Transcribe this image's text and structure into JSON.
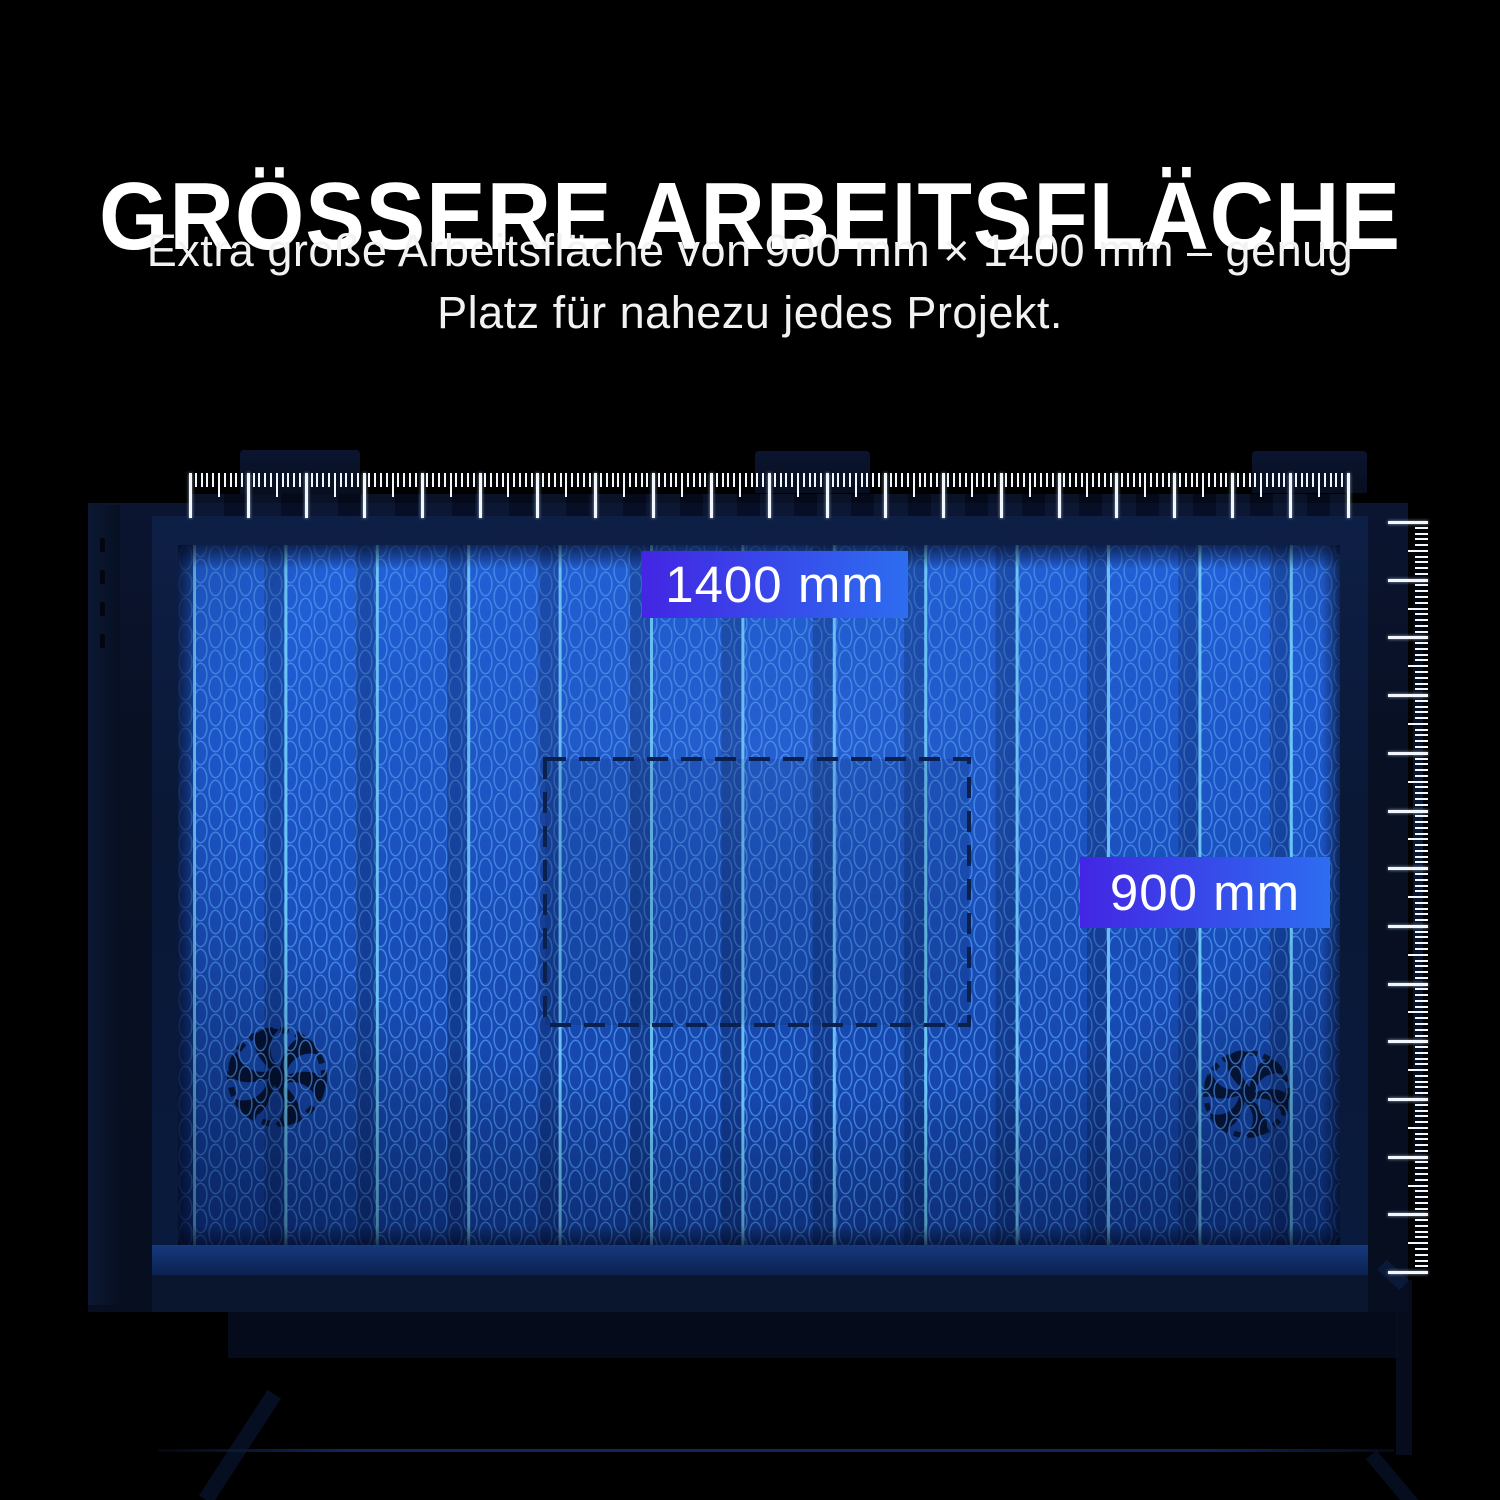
{
  "header": {
    "title": "GRÖSSERE ARBEITSFLÄCHE",
    "subtitle": [
      "Extra große Arbeitsfläche von 900 mm × 1400 mm – genug",
      "Platz für nahezu jedes Projekt."
    ]
  },
  "dimension_labels": {
    "width": "1400 mm",
    "height": "900 mm"
  },
  "work_area": {
    "width_mm": 1400,
    "height_mm": 900
  },
  "colors": {
    "background": "#000000",
    "label_gradient_from": "#4326e4",
    "label_gradient_to": "#2d6df0",
    "bed_blue_top": "#2261da",
    "bed_blue_bottom": "#123f9e",
    "honeycomb_stroke": "#4c92f0",
    "panel_line_cyan": "#79d6ff",
    "ruler_tick": "#f2f6ff",
    "frame_navy": "#0a1836"
  },
  "illustration": {
    "rulers": {
      "top": {
        "tick_count": 201,
        "pitch": 5.79,
        "major_every": 10,
        "medium_every": 5
      },
      "right": {
        "tick_count": 131,
        "pitch": 5.77,
        "major_every": 10,
        "medium_every": 5
      }
    },
    "bed_panels": {
      "line_count": 13,
      "spacing": 91.4,
      "first_x": 15
    }
  }
}
